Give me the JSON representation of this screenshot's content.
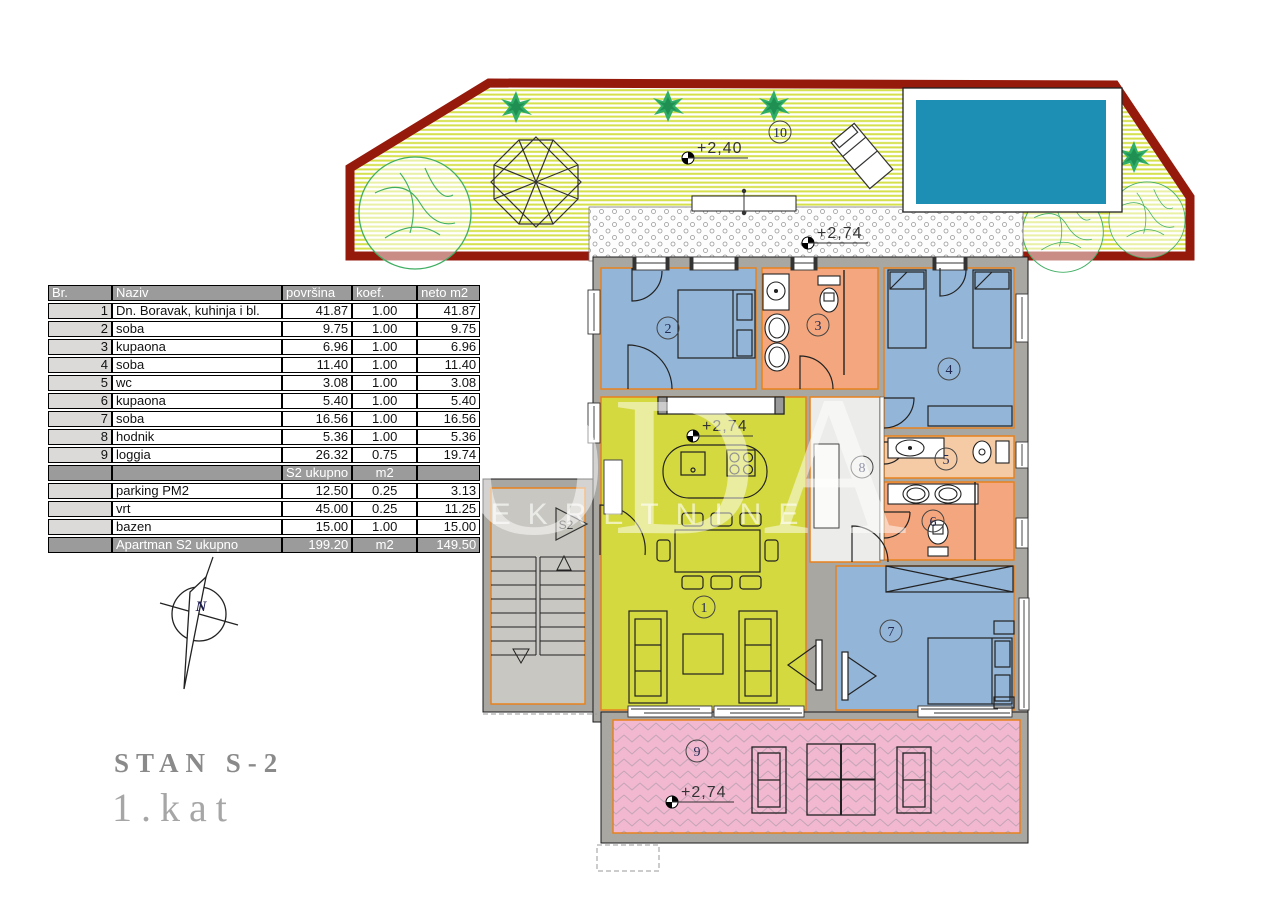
{
  "title": {
    "line1": "STAN S-2",
    "line2": "1.kat"
  },
  "compass": {
    "label": "N"
  },
  "watermark": {
    "line1": "JODA",
    "line2": "NEKRETNINE"
  },
  "entrance": {
    "label": "S2"
  },
  "levels": {
    "garden": "+2,40",
    "path": "+2,74",
    "living": "+2,74",
    "loggia": "+2,74"
  },
  "rooms": {
    "n1": "1",
    "n2": "2",
    "n3": "3",
    "n4": "4",
    "n5": "5",
    "n6": "6",
    "n7": "7",
    "n8": "8",
    "n9": "9",
    "n10": "10"
  },
  "table": {
    "headers": [
      "Br.",
      "Naziv",
      "površina",
      "koef.",
      "neto m2"
    ],
    "rows": [
      {
        "br": "1",
        "naziv": "Dn. Boravak, kuhinja i bl.",
        "povrsina": "41.87",
        "koef": "1.00",
        "neto": "41.87"
      },
      {
        "br": "2",
        "naziv": "soba",
        "povrsina": "9.75",
        "koef": "1.00",
        "neto": "9.75"
      },
      {
        "br": "3",
        "naziv": "kupaona",
        "povrsina": "6.96",
        "koef": "1.00",
        "neto": "6.96"
      },
      {
        "br": "4",
        "naziv": "soba",
        "povrsina": "11.40",
        "koef": "1.00",
        "neto": "11.40"
      },
      {
        "br": "5",
        "naziv": "wc",
        "povrsina": "3.08",
        "koef": "1.00",
        "neto": "3.08"
      },
      {
        "br": "6",
        "naziv": "kupaona",
        "povrsina": "5.40",
        "koef": "1.00",
        "neto": "5.40"
      },
      {
        "br": "7",
        "naziv": "soba",
        "povrsina": "16.56",
        "koef": "1.00",
        "neto": "16.56"
      },
      {
        "br": "8",
        "naziv": "hodnik",
        "povrsina": "5.36",
        "koef": "1.00",
        "neto": "5.36"
      },
      {
        "br": "9",
        "naziv": "loggia",
        "povrsina": "26.32",
        "koef": "0.75",
        "neto": "19.74"
      },
      {
        "br": "",
        "naziv": "parking PM2",
        "povrsina": "12.50",
        "koef": "0.25",
        "neto": "3.13"
      },
      {
        "br": "",
        "naziv": "vrt",
        "povrsina": "45.00",
        "koef": "0.25",
        "neto": "11.25"
      },
      {
        "br": "",
        "naziv": "bazen",
        "povrsina": "15.00",
        "koef": "1.00",
        "neto": "15.00"
      }
    ],
    "subheader": {
      "povrsina": "S2 ukupno",
      "koef": "m2"
    },
    "total": {
      "naziv": "Apartman S2 ukupno",
      "povrsina": "199.20",
      "koef": "m2",
      "neto": "149.50"
    }
  },
  "colors": {
    "garden_border": "#951A0C",
    "garden_stripe": "#D5E04A",
    "pool": "#1E8FB4",
    "bedroom": "#93B5D8",
    "bathroom": "#F4A77E",
    "wc": "#F5CBA6",
    "living": "#D4D93F",
    "loggia": "#F1B8CF",
    "wall": "#A8A7A2",
    "stair_floor": "#C8C7C1",
    "hall_floor": "#ECECEA",
    "accent_line": "#E8821C",
    "table_header_bg": "#9C9B9B",
    "tree_green": "#35AE66"
  }
}
